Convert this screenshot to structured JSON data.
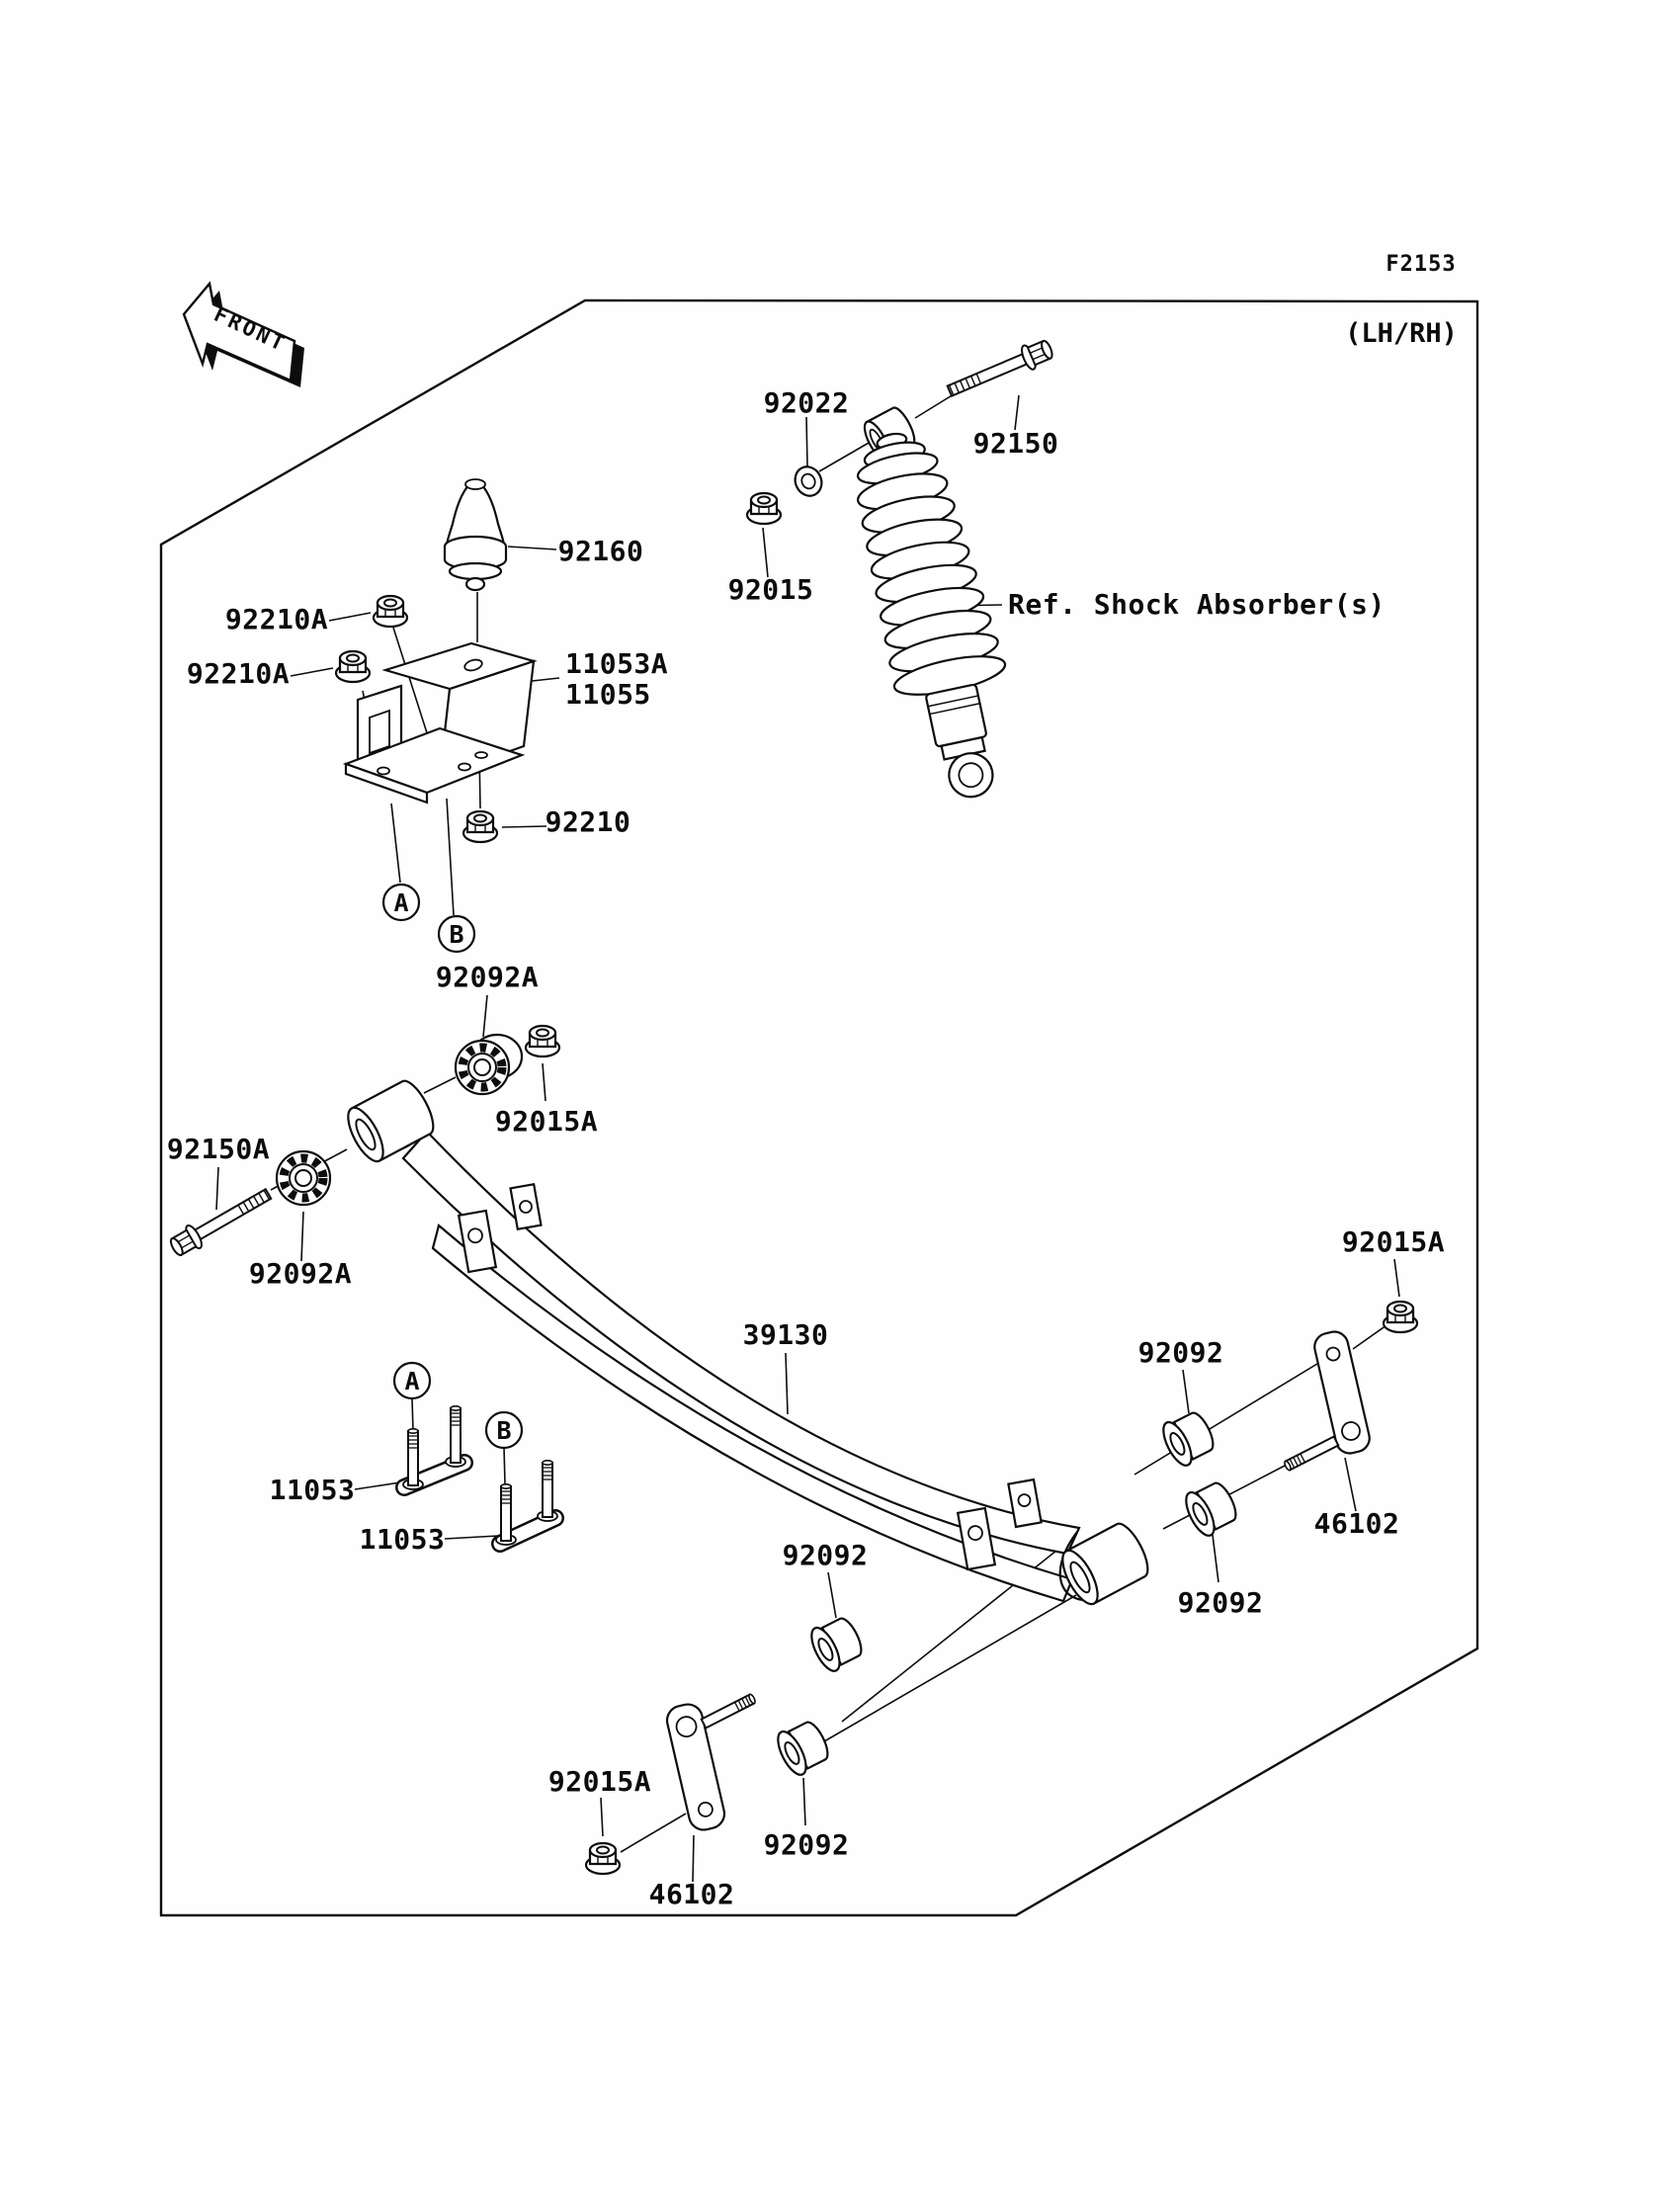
{
  "figure": {
    "code": "F2153",
    "variant": "(LH/RH)",
    "front_marker": "FRONT",
    "ref_shock": "Ref. Shock Absorber(s)"
  },
  "callouts": {
    "a": "A",
    "b": "B"
  },
  "parts": {
    "washer_shock": "92022",
    "bolt_shock": "92150",
    "nut_shock": "92015",
    "damper_bumper": "92160",
    "nut_bracket_flanged_1": "92210A",
    "nut_bracket_flanged_2": "92210A",
    "bracket_main": "11053A",
    "bracket_alt": "11055",
    "nut_bracket_lock": "92210",
    "collar_splined_upper": "92092A",
    "nut_pivot": "92015A",
    "bolt_pivot": "92150A",
    "collar_splined_lower": "92092A",
    "leaf_spring": "39130",
    "ubolt_front": "11053",
    "ubolt_rear": "11053",
    "bushing_shackle_upper": "92092",
    "bushing_shackle_lower": "92092",
    "bushing_shackle_right_upper": "92092",
    "bushing_shackle_right_lower": "92092",
    "nut_shackle_left": "92015A",
    "nut_shackle_right": "92015A",
    "plate_shackle_left": "46102",
    "plate_shackle_right": "46102"
  }
}
